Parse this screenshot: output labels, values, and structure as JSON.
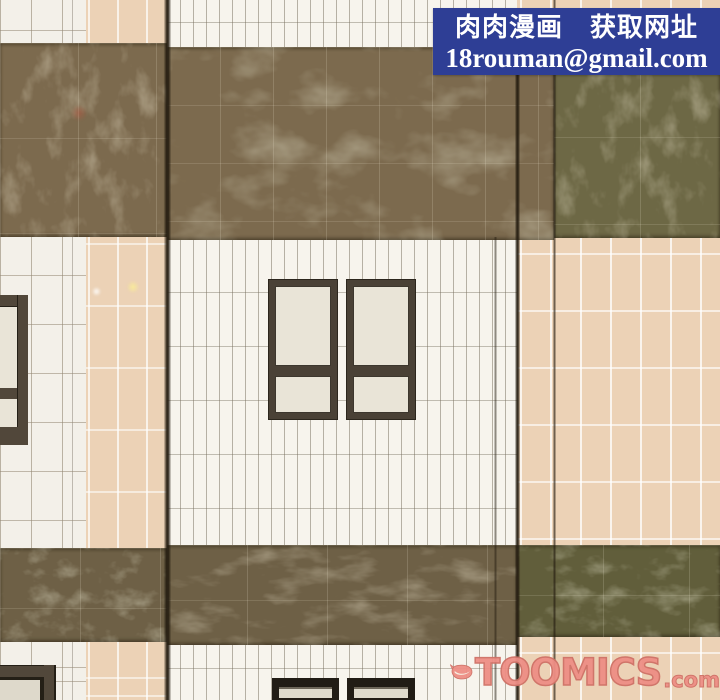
{
  "banner": {
    "line1": "肉肉漫画　获取网址",
    "line2": "18rouman@gmail.com"
  },
  "watermark": {
    "logo_icon": "toomics-swoosh-icon",
    "brand": "TOOMICS",
    "suffix": ".com"
  },
  "palette": {
    "banner_bg": "#2e3e95",
    "banner_fg": "#ffffff",
    "watermark_pink": "#ee8e85",
    "band_brown": "#7c6a4e",
    "band_brown_low": "#6e6046",
    "band_green": "#6d6845",
    "band_green_low": "#615e3b",
    "tile_white": "#f3f0e9",
    "tile_cream": "#f7f4ed",
    "tile_peach": "#ecd2b6",
    "pane_cream": "#e9e4d7",
    "frame_brown": "#4a4136",
    "frame_dark": "#2c261d"
  }
}
